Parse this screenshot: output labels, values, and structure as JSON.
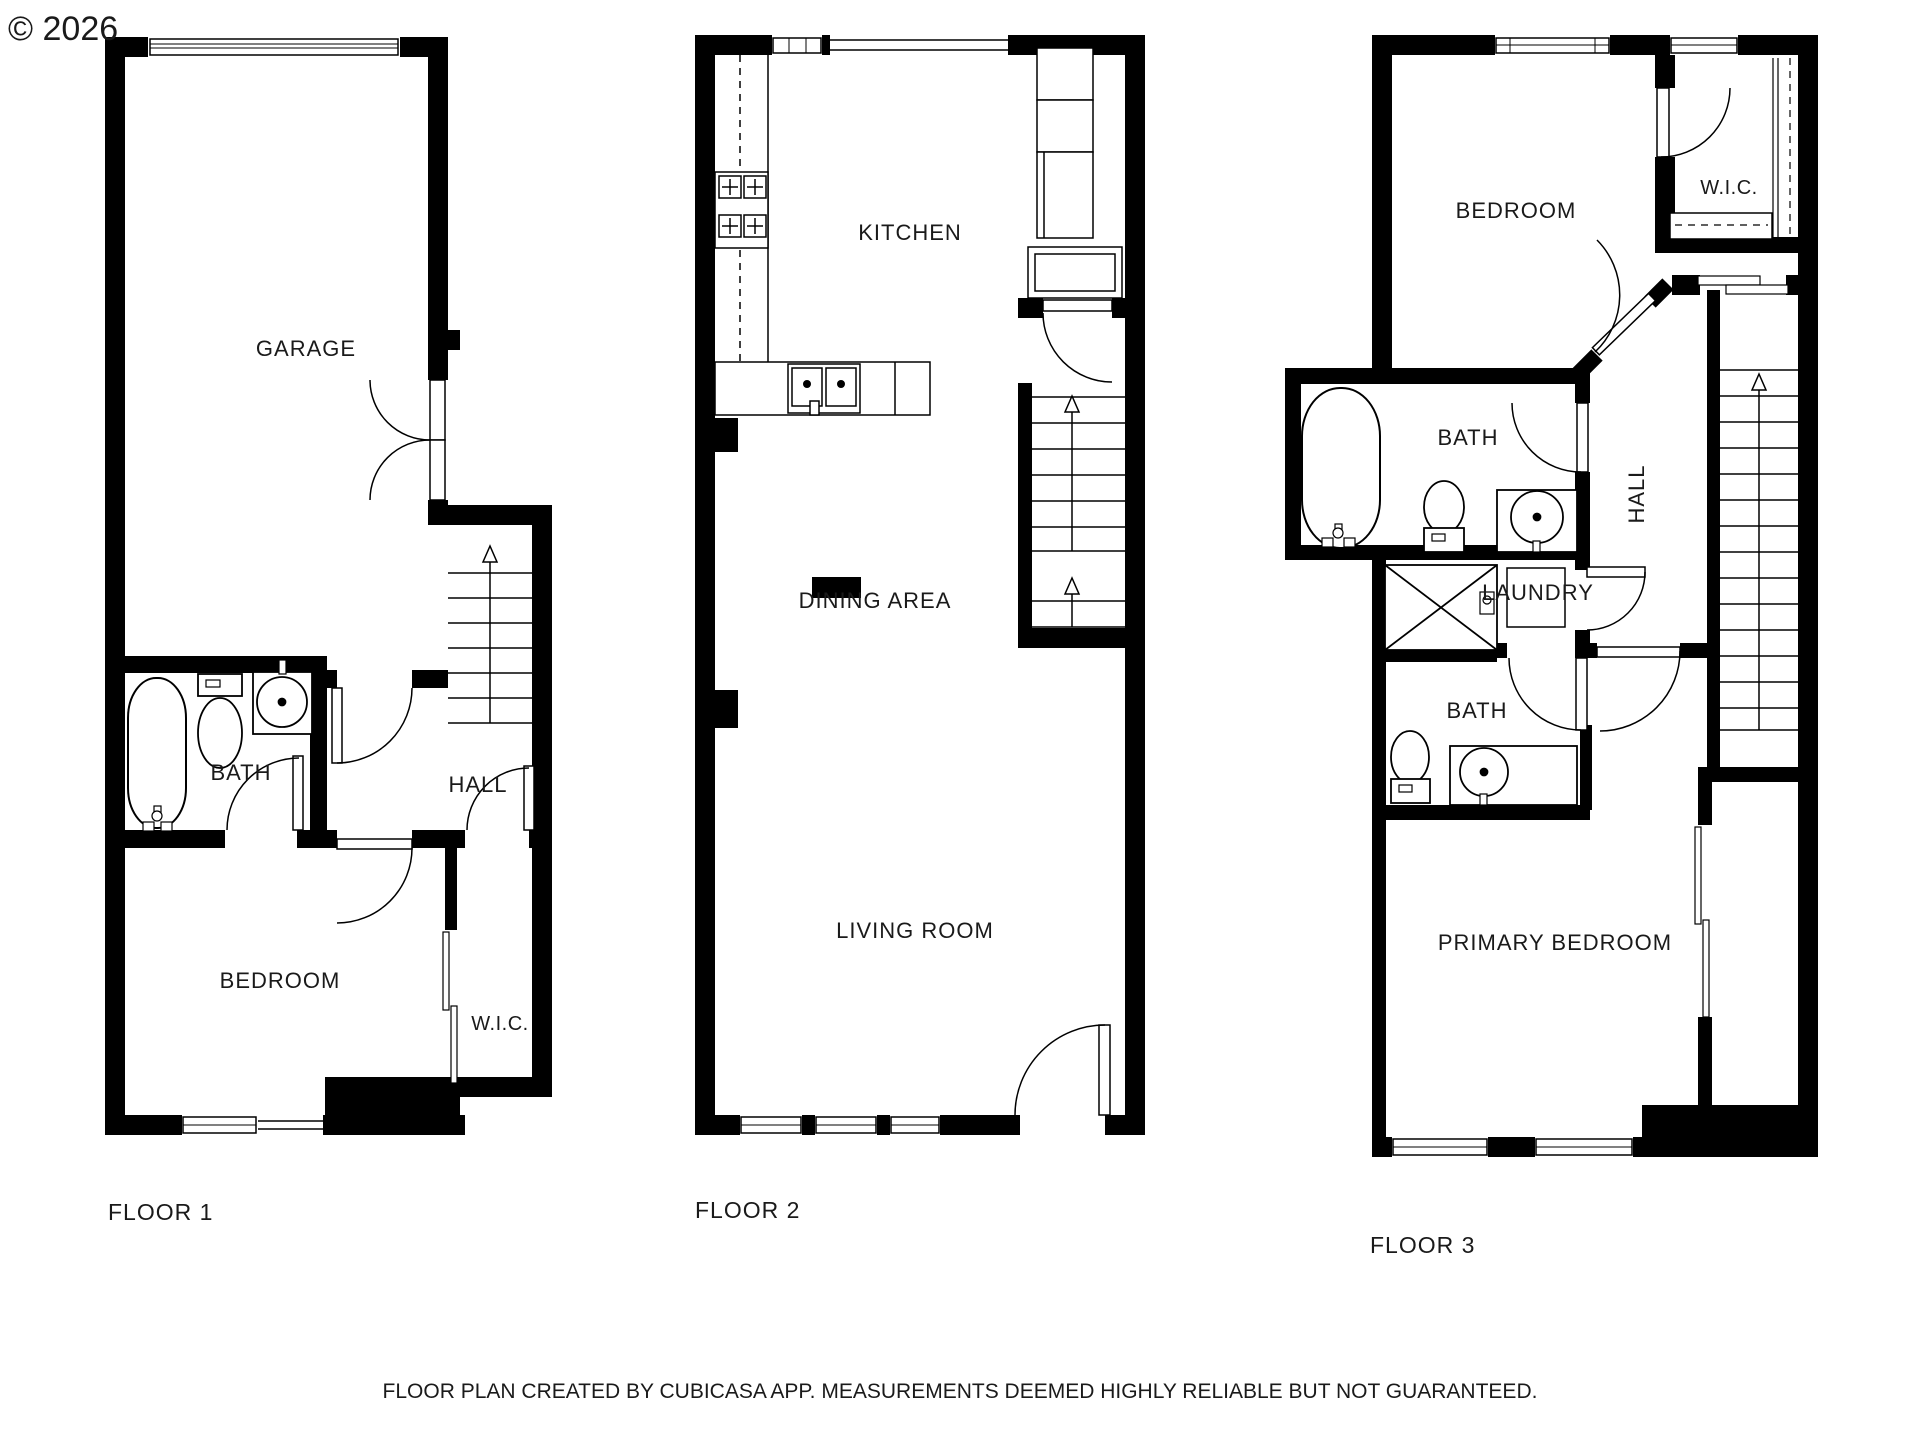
{
  "watermark": "© 2026",
  "floors": [
    {
      "label": "FLOOR 1",
      "rooms": {
        "garage": "GARAGE",
        "bath": "BATH",
        "hall": "HALL",
        "bedroom": "BEDROOM",
        "wic": "W.I.C."
      }
    },
    {
      "label": "FLOOR 2",
      "rooms": {
        "kitchen": "KITCHEN",
        "dining": "DINING AREA",
        "living": "LIVING ROOM"
      }
    },
    {
      "label": "FLOOR 3",
      "rooms": {
        "bedroom": "BEDROOM",
        "wic": "W.I.C.",
        "bath_upper": "BATH",
        "hall": "HALL",
        "laundry": "LAUNDRY",
        "bath_lower": "BATH",
        "primary": "PRIMARY BEDROOM"
      }
    }
  ],
  "disclaimer": "FLOOR PLAN CREATED BY CUBICASA APP. MEASUREMENTS DEEMED HIGHLY RELIABLE BUT NOT GUARANTEED.",
  "colors": {
    "wall": "#000000",
    "background": "#ffffff",
    "watermark": "#8f8f8f",
    "text": "#1a1a1a"
  }
}
